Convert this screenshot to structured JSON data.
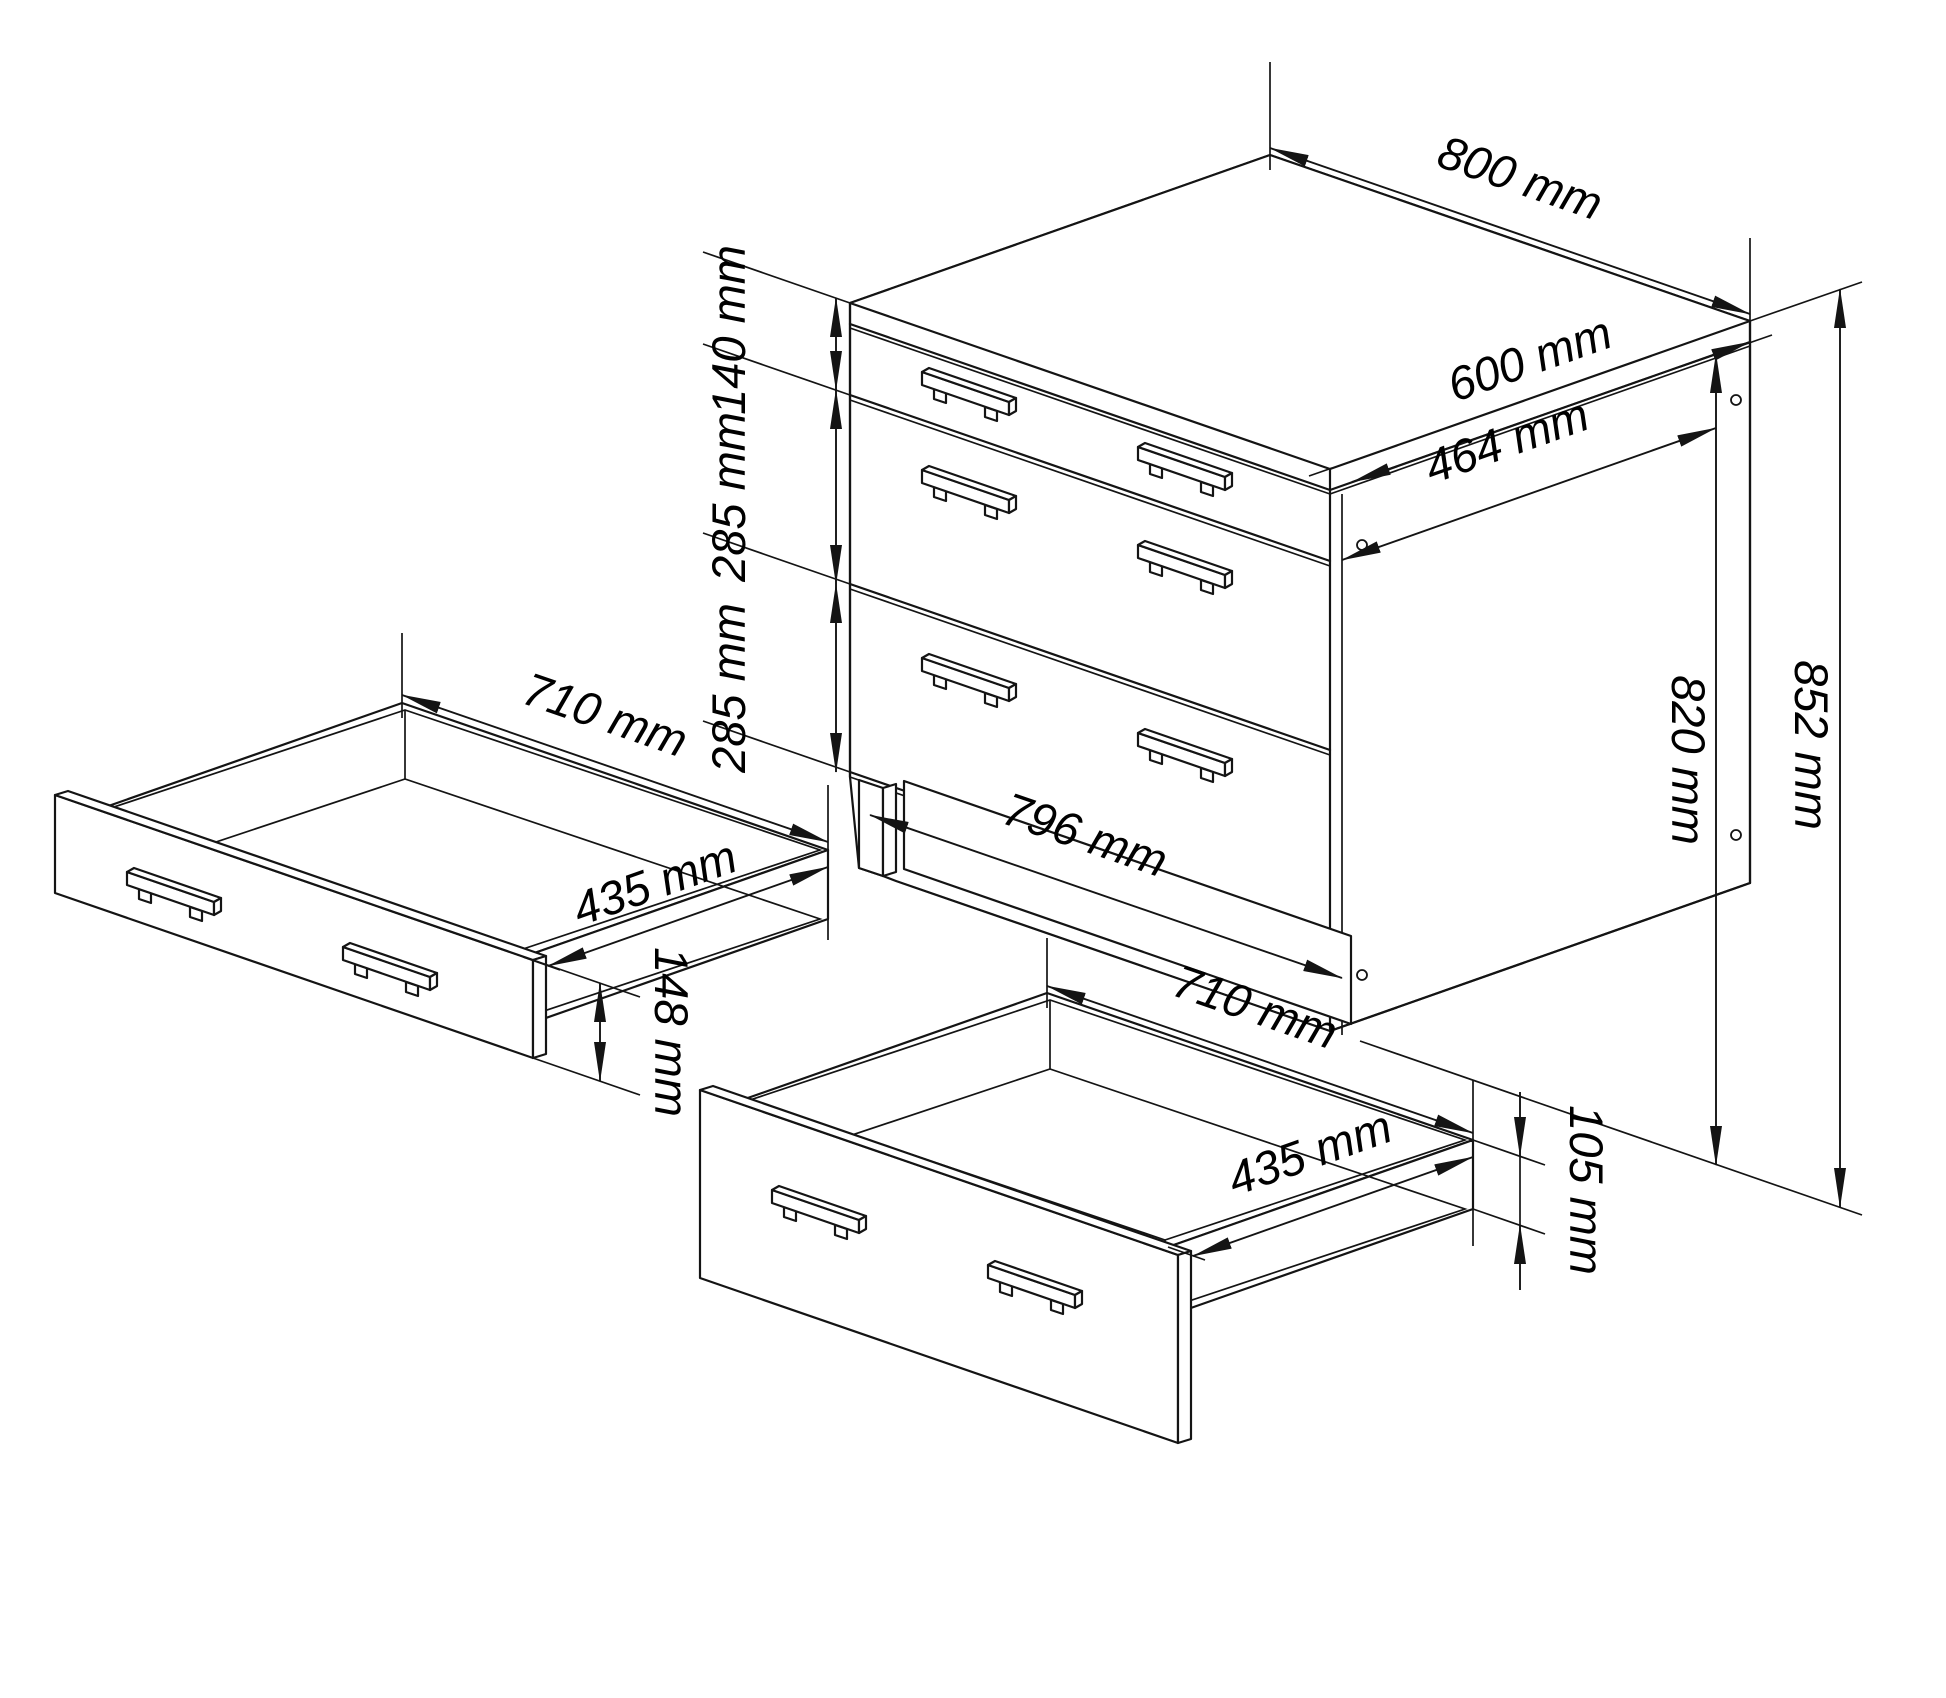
{
  "page": {
    "background": "#ffffff",
    "line_color": "#141414",
    "drawing_type": "furniture assembly dimension drawing",
    "subject": "chest of drawers with three drawers and two pulled-out drawer boxes"
  },
  "cabinet": {
    "labels": {
      "width_top": "800 mm",
      "depth_top": "600 mm",
      "inner_depth": "464 mm",
      "height_total": "852 mm",
      "height_carcass": "820 mm",
      "front_width": "796 mm",
      "drawer1_height": "140 mm",
      "drawer2_height": "285 mm",
      "drawer3_height": "285 mm"
    }
  },
  "drawer_small": {
    "labels": {
      "width": "710 mm",
      "depth": "435 mm",
      "front_height": "148 mm"
    }
  },
  "drawer_large": {
    "labels": {
      "width": "710 mm",
      "depth": "435 mm",
      "box_height": "105 mm"
    }
  }
}
